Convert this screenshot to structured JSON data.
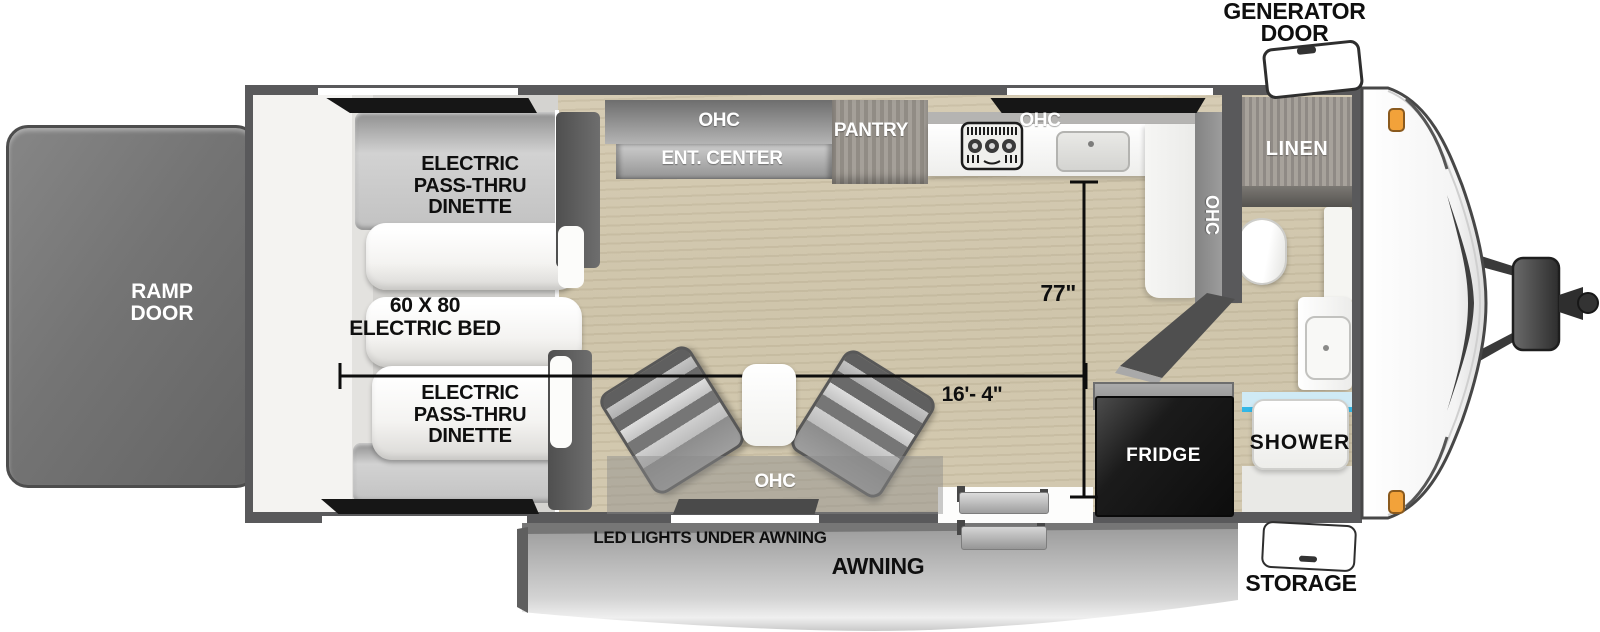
{
  "floorplan": {
    "ramp_door_lines": [
      "RAMP",
      "DOOR"
    ],
    "generator_door_lines": [
      "GENERATOR",
      "DOOR"
    ],
    "storage_label": "STORAGE",
    "awning_label": "AWNING",
    "led_lights_label": "LED LIGHTS UNDER AWNING",
    "dinette_front_lines": [
      "ELECTRIC",
      "PASS-THRU",
      "DINETTE"
    ],
    "dinette_rear_lines": [
      "ELECTRIC",
      "PASS-THRU",
      "DINETTE"
    ],
    "bed_lines": [
      "60 X 80",
      "ELECTRIC BED"
    ],
    "cabinets": {
      "ohc_entertainment": "OHC",
      "ent_center": "ENT. CENTER",
      "pantry": "PANTRY",
      "ohc_kitchen": "OHC",
      "ohc_kitchen_side": "OHC",
      "ohc_sofa": "OHC",
      "linen": "LINEN"
    },
    "appliances": {
      "fridge": "FRIDGE",
      "shower": "SHOWER"
    },
    "dimensions": {
      "kitchen_to_door": "77\"",
      "garage_length": "16'- 4\""
    },
    "colors": {
      "wall": "#59595b",
      "floor": "#d0c6ac",
      "water_accent": "#33b7e6",
      "clearance_light": "#f2a23a",
      "fridge": "#141414"
    }
  }
}
